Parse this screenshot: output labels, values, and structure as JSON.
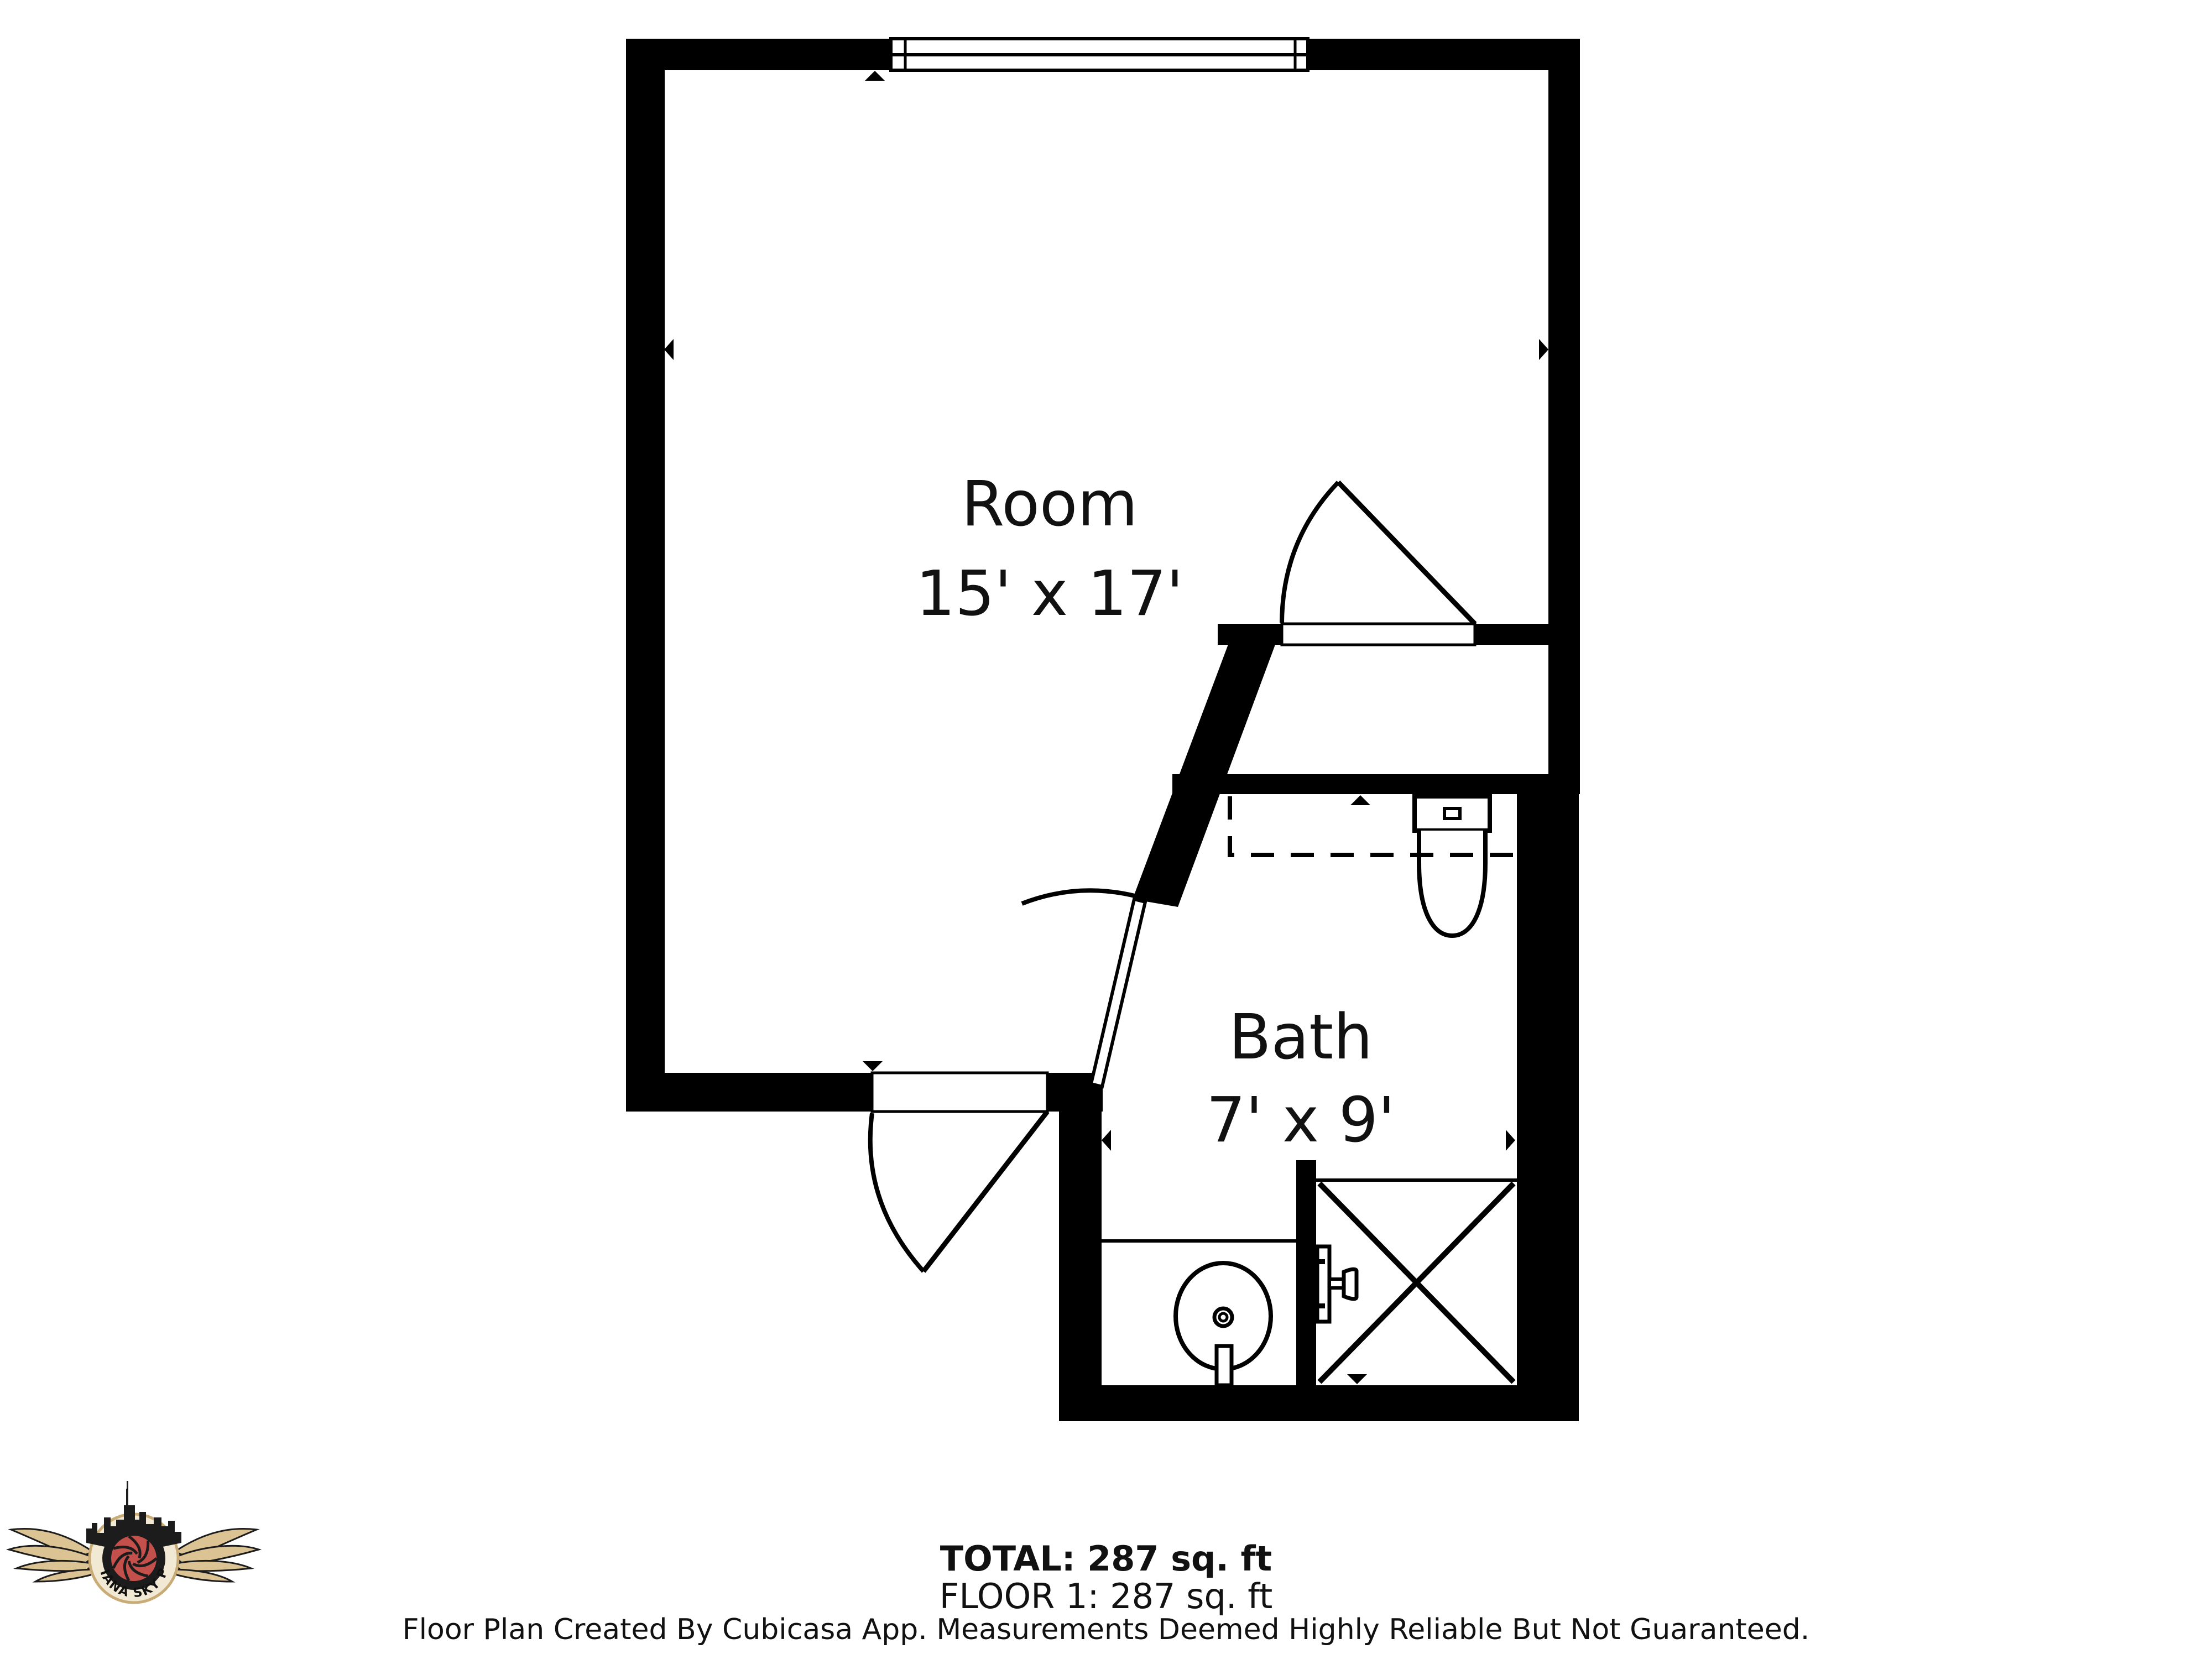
{
  "floor_plan": {
    "rooms": [
      {
        "name": "Room",
        "dimensions": "15' x 17'"
      },
      {
        "name": "Bath",
        "dimensions": "7' x 9'"
      }
    ],
    "summary": {
      "total_label": "TOTAL: 287 sq. ft",
      "floor_label": "FLOOR 1: 287 sq. ft"
    },
    "disclaimer": "Floor Plan Created By Cubicasa App. Measurements Deemed Highly Reliable But Not Guaranteed.",
    "colors": {
      "wall": "#000000",
      "background": "#ffffff"
    }
  },
  "logo": {
    "text": "INDIANA SKY PICS",
    "colors": {
      "red": "#c4504b",
      "tan": "#dcc394",
      "cream": "#f2e9d4",
      "outline": "#1c1c1c"
    }
  }
}
